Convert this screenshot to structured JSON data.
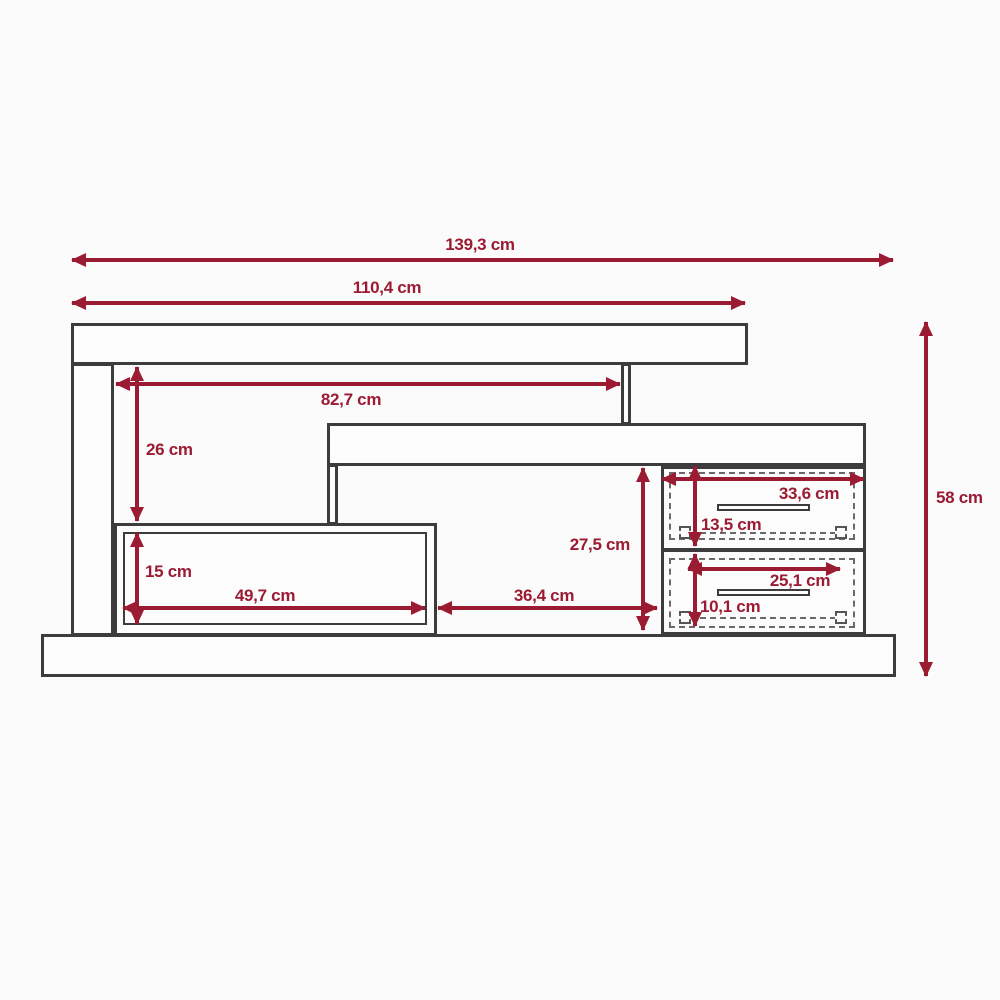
{
  "drawing": {
    "type": "furniture dimensional diagram",
    "subject": "tv-stand with drawers, front elevation",
    "unit": "cm",
    "colors": {
      "dimension_accent": "#9b1b32",
      "outline": "#3c3c3c",
      "background": "#fbfbfb"
    }
  },
  "labels": {
    "total_width": "139,3 cm",
    "upper_width": "110,4 cm",
    "inner_width": "82,7 cm",
    "upper_opening_height": "26 cm",
    "shelf_opening_height": "15 cm",
    "shelf_opening_width": "49,7 cm",
    "middle_gap_width": "36,4 cm",
    "drawer_section_height": "27,5 cm",
    "total_height": "58 cm",
    "top_drawer_width": "33,6 cm",
    "top_drawer_height": "13,5 cm",
    "bottom_drawer_width": "25,1 cm",
    "bottom_drawer_height": "10,1 cm"
  }
}
